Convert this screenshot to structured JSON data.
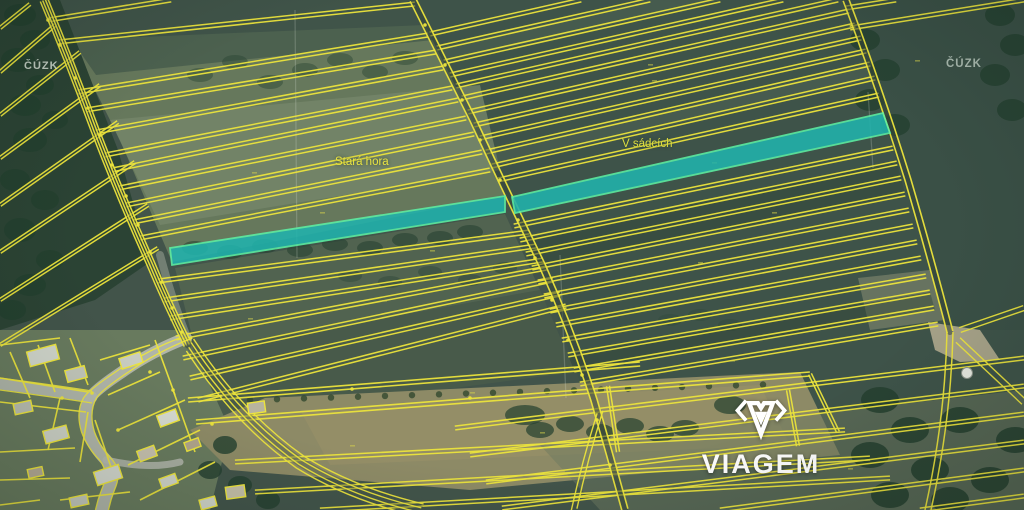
{
  "map": {
    "type": "cadastral-parcel-map",
    "watermark_top_left": "ČÚZK",
    "watermark_top_right": "ČÚZK",
    "labels": {
      "stara_hora": "Stará hora",
      "v_sadcich": "V sádcích"
    },
    "brand": {
      "name": "VIAGEM"
    },
    "colors": {
      "parcel_line": "#ece43c",
      "parcel_line_dim": "#d8d44a",
      "highlight_fill": "#21b3ad",
      "highlight_stroke": "#5df0a4",
      "road_gray": "#b6bab0",
      "logo_white": "#ffffff"
    }
  }
}
